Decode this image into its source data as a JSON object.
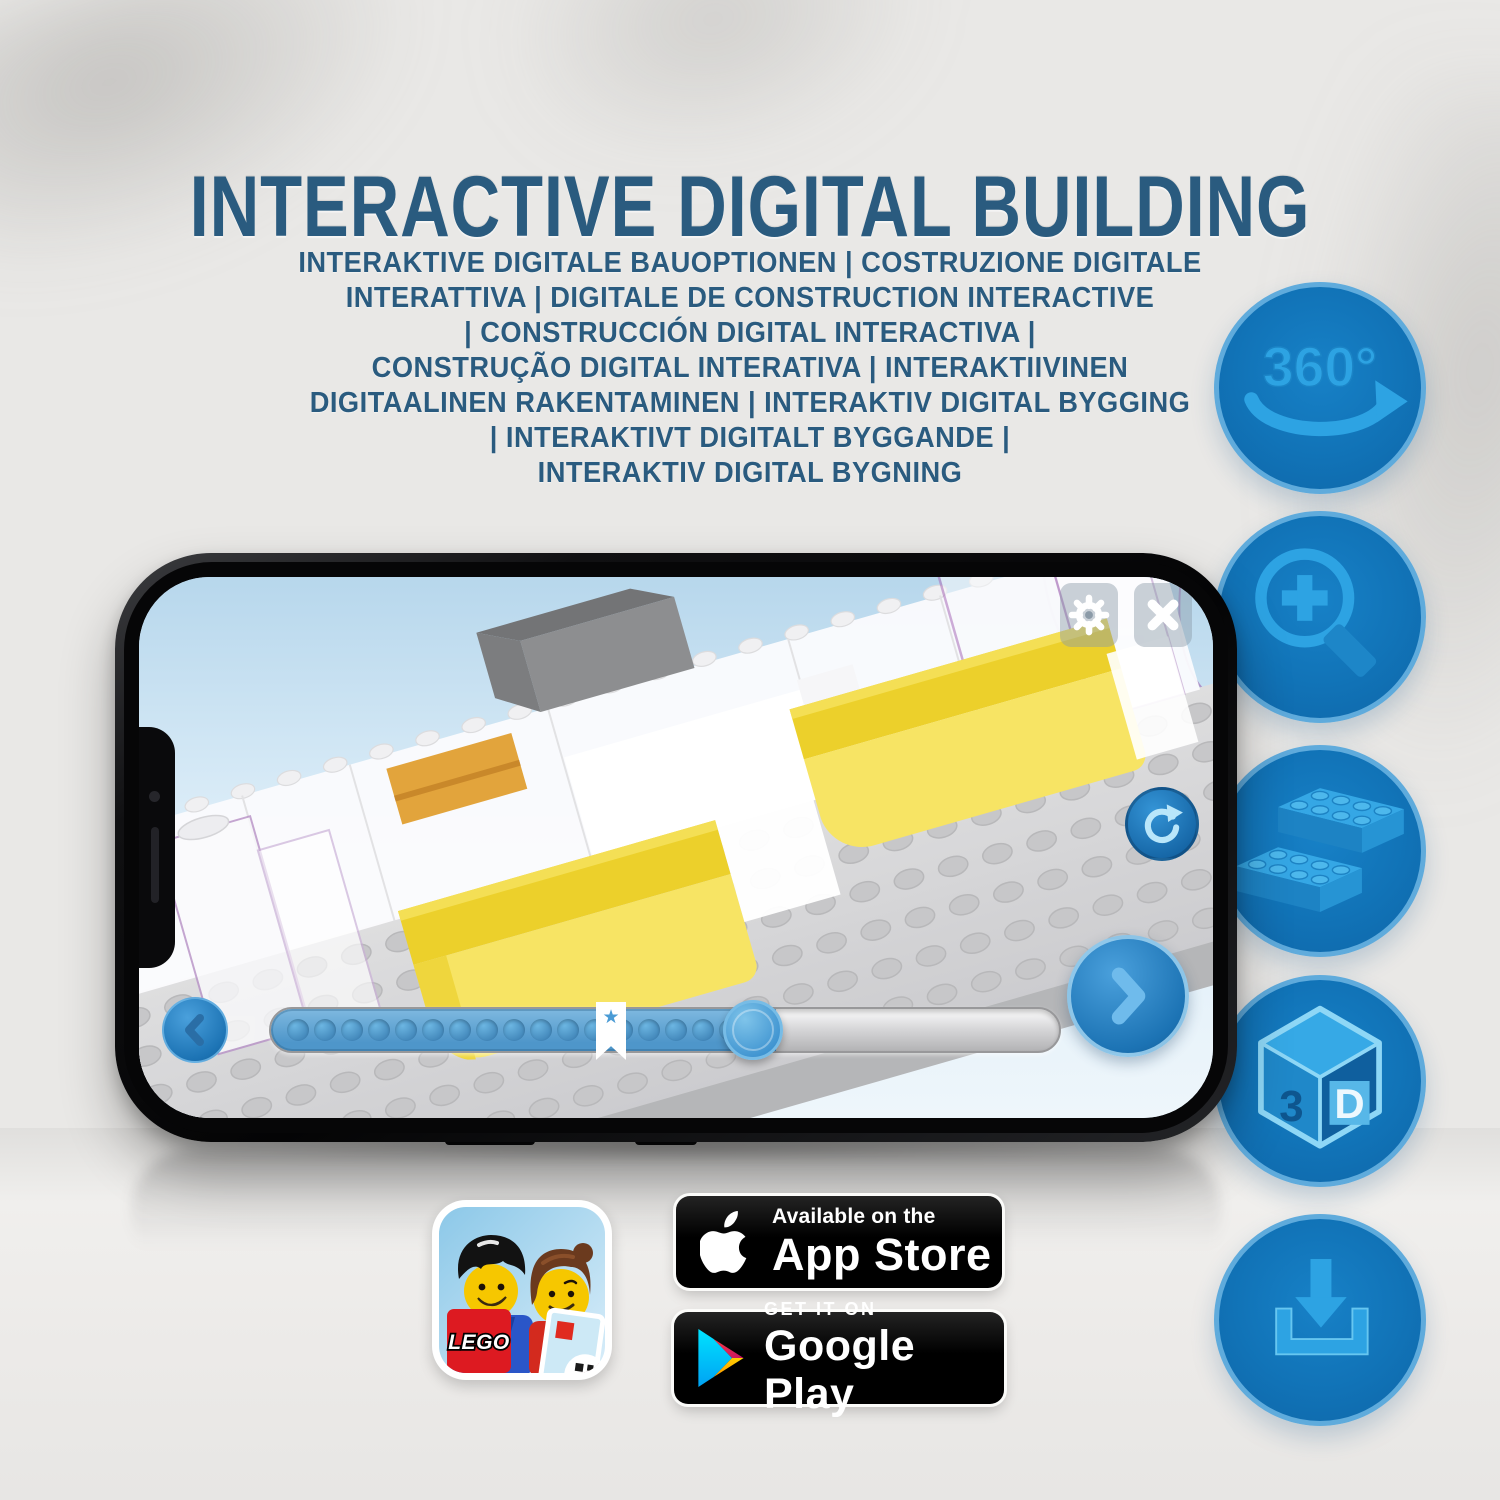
{
  "title": "INTERACTIVE DIGITAL BUILDING",
  "subtitle": {
    "lines": [
      "INTERAKTIVE DIGITALE BAUOPTIONEN | COSTRUZIONE DIGITALE",
      "INTERATTIVA | DIGITALE DE CONSTRUCTION INTERACTIVE",
      "| CONSTRUCCIÓN DIGITAL INTERACTIVA |",
      "CONSTRUÇÃO DIGITAL INTERATIVA | INTERAKTIIVINEN",
      "DIGITAALINEN RAKENTAMINEN | INTERAKTIV DIGITAL BYGGING",
      "| INTERAKTIVT DIGITALT BYGGANDE |",
      "INTERAKTIV DIGITAL BYGNING"
    ]
  },
  "feature_icons": {
    "rotate_360": {
      "icon": "360-rotation-icon",
      "label": "360°"
    },
    "zoom_in": {
      "icon": "zoom-in-magnifier-icon"
    },
    "bricks": {
      "icon": "lego-bricks-icon"
    },
    "cube_3d": {
      "icon": "3d-cube-icon",
      "left": "3",
      "right": "D"
    },
    "download": {
      "icon": "download-icon"
    }
  },
  "phone": {
    "ui_icons": [
      "gear-icon",
      "close-icon",
      "reset-view-icon",
      "chevron-left-icon",
      "chevron-right-icon",
      "bookmark-star-icon"
    ],
    "progress": {
      "dots_filled": 17,
      "fill_ratio": "0.63"
    }
  },
  "store": {
    "lego_app": {
      "logo": "LEGO"
    },
    "app_store": {
      "tagline": "Available on the",
      "name": "App Store"
    },
    "google_play": {
      "tagline": "GET IT ON",
      "name": "Google Play"
    }
  },
  "colors": {
    "title_blue": "#2a5b7f",
    "circle_fill": "#1173b7",
    "circle_border": "#5fabdc",
    "glyph_blue": "#2da3e3",
    "bed_yellow": "#f2d73c",
    "badge_black": "#000000",
    "lego_red": "#dd1a21"
  }
}
